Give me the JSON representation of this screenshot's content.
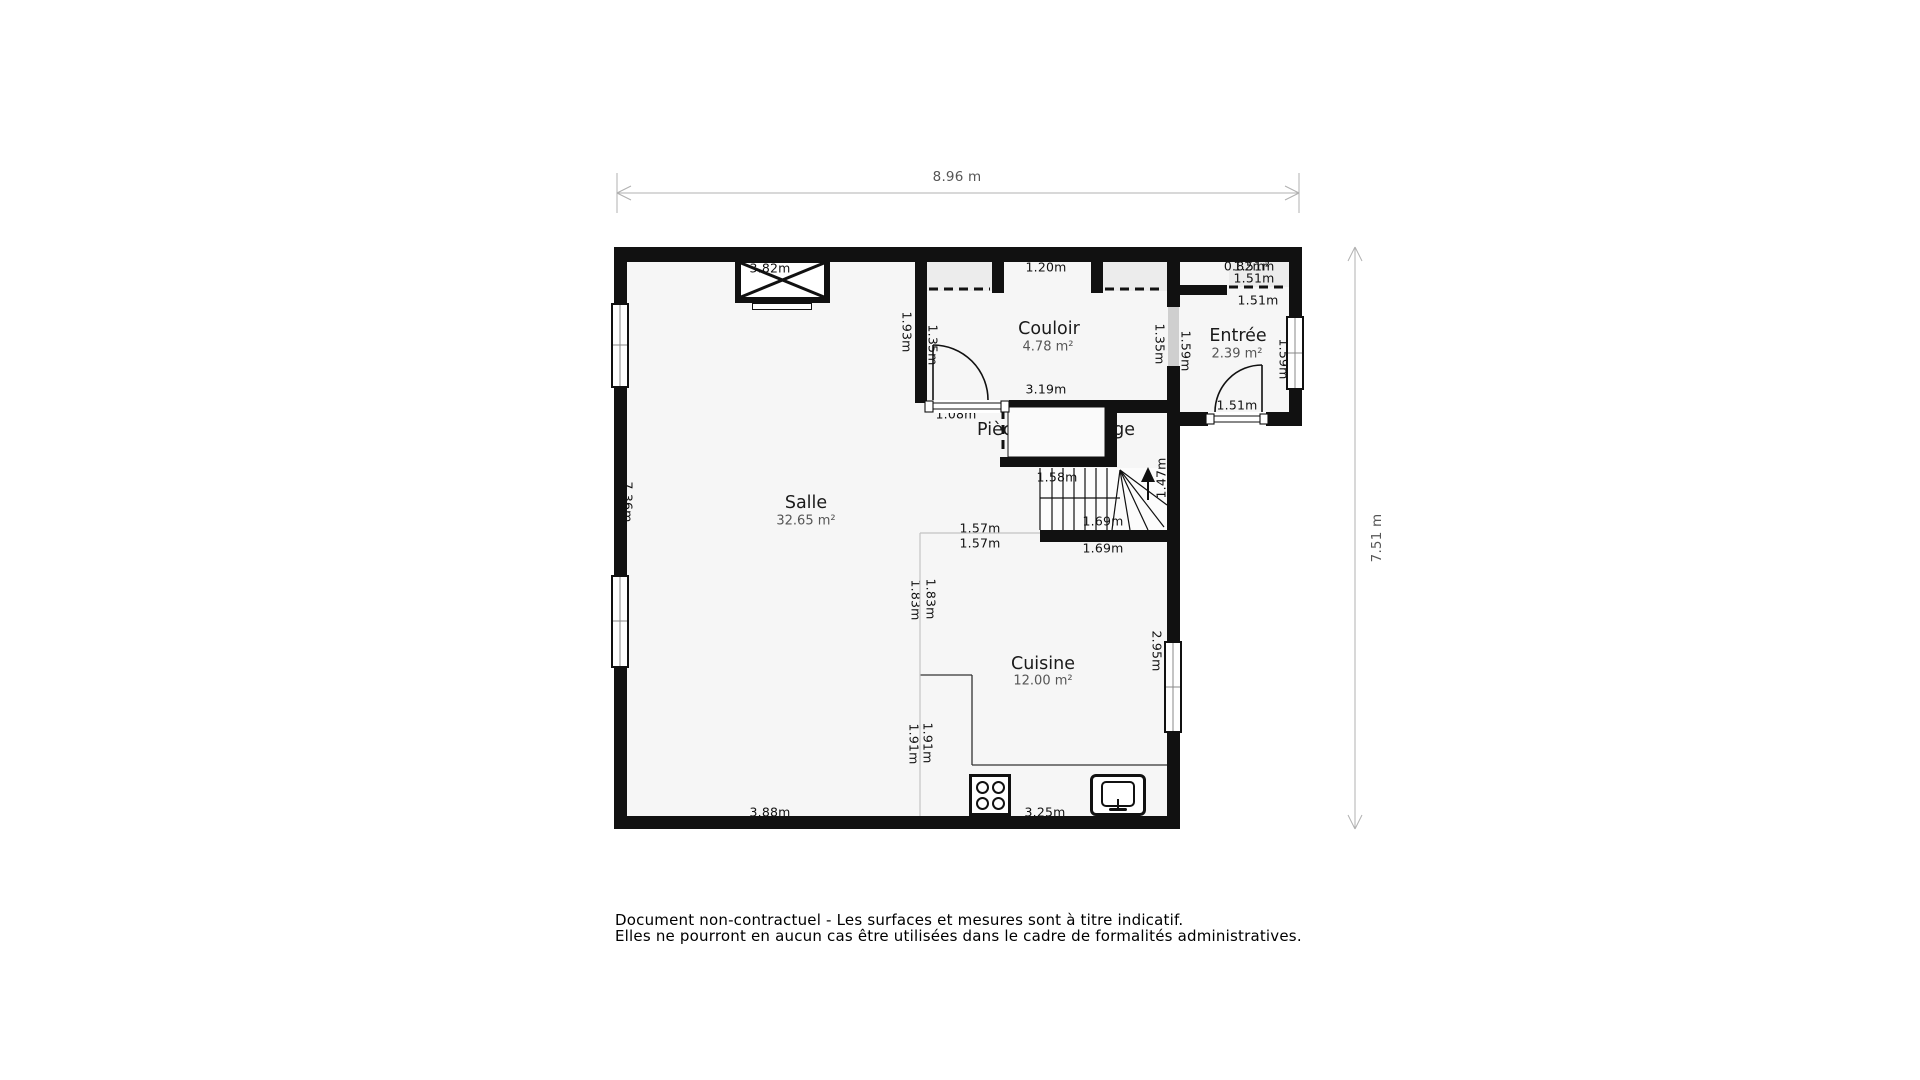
{
  "plan": {
    "overall": {
      "width_label": "8.96 m",
      "height_label": "7.51 m"
    },
    "rooms": [
      {
        "name": "Salle",
        "area": "32.65 m²"
      },
      {
        "name": "Couloir",
        "area": "4.78 m²"
      },
      {
        "name": "Entrée",
        "area": "2.39 m²"
      },
      {
        "name": "Pièce de stockage",
        "area": "0.85 m²"
      },
      {
        "name": "Cuisine",
        "area": "12.00 m²"
      }
    ],
    "dims": [
      {
        "text": "3.82m"
      },
      {
        "text": "1.20m"
      },
      {
        "text": "0.82m²"
      },
      {
        "text": "1.51m"
      },
      {
        "text": "1.51m"
      },
      {
        "text": "1.51m"
      },
      {
        "text": "3.19m"
      },
      {
        "text": "1.08m"
      },
      {
        "text": "1.28m"
      },
      {
        "text": "1.28m"
      },
      {
        "text": "1.58m"
      },
      {
        "text": "1.69m"
      },
      {
        "text": "1.69m"
      },
      {
        "text": "1.57m"
      },
      {
        "text": "1.57m"
      },
      {
        "text": "1.51m"
      },
      {
        "text": "3.88m"
      },
      {
        "text": "3.25m"
      },
      {
        "text": "7.36m"
      },
      {
        "text": "1.93m"
      },
      {
        "text": "1.35m"
      },
      {
        "text": "1.35m"
      },
      {
        "text": "1.59m"
      },
      {
        "text": "1.59m"
      },
      {
        "text": "1.47m"
      },
      {
        "text": "2.95m"
      },
      {
        "text": "1.83m"
      },
      {
        "text": "1.83m"
      },
      {
        "text": "1.91m"
      },
      {
        "text": "1.91m"
      }
    ]
  },
  "disclaimer": {
    "line1": "Document non-contractuel - Les surfaces et mesures sont à titre indicatif.",
    "line2": "Elles ne pourront en aucun cas être utilisées dans le cadre de formalités administratives."
  },
  "colors": {
    "wall": "#111111",
    "floor": "#f6f6f6",
    "closet_fill": "#ececec",
    "door_panel": "#cfcfcf",
    "dimension_line": "#b0b0b0",
    "overall_dim_text": "#555555",
    "label_text": "#111111",
    "room_area_text": "#555555"
  }
}
